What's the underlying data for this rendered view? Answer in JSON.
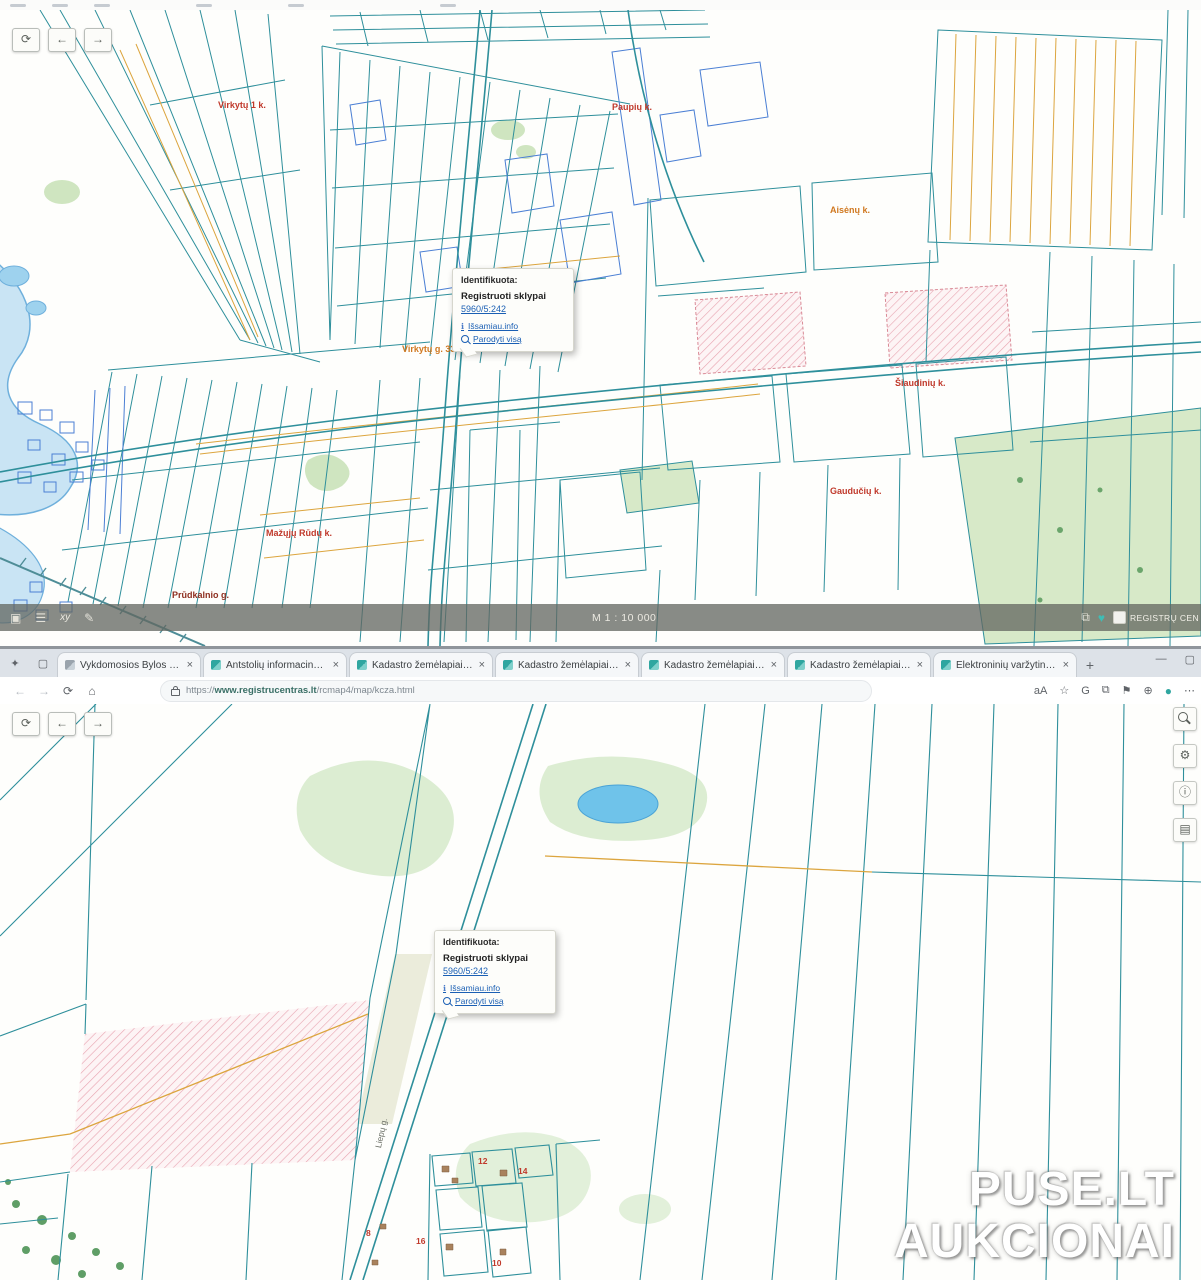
{
  "colors": {
    "teal": "#2e8f9b",
    "blue": "#4b7fd4",
    "orange": "#dca53e",
    "water": "#79c2e8",
    "green": "#d9ecd0",
    "pink": "#e6a7b4",
    "link": "#1a5fb4",
    "label-red": "#c0392b",
    "label-orange": "#d07820",
    "heart": "#3fbdb5"
  },
  "watermark": {
    "line1": "PUSE.LT",
    "line2": "AUKCIONAI"
  },
  "top_map": {
    "popup": {
      "header": "Identifikuota:",
      "title": "Registruoti sklypai",
      "parcel_link": "5960/5:242",
      "info_link": "Išsamiau.info",
      "zoom_link": "Parodyti visą"
    },
    "labels": [
      {
        "text": "Virkytų 1 k."
      },
      {
        "text": "Paupių k."
      },
      {
        "text": "Aisėnų k."
      },
      {
        "text": "Šiaudinių k."
      },
      {
        "text": "Gaudučių k."
      },
      {
        "text": "Mažųjų Rūdų k."
      },
      {
        "text": "Virkytų g. 33 k."
      },
      {
        "text": "Prūdkalnio g."
      }
    ],
    "statusbar": {
      "xy_label": "xy",
      "scale": "M 1 : 10 000",
      "brand": "REGISTRŲ CENTRAS"
    }
  },
  "browser": {
    "tabs": [
      {
        "label": "Vykdomosios Bylos Portalas"
      },
      {
        "label": "Antstolių informacinė sistema"
      },
      {
        "label": "Kadastro žemėlapiai 4.1.25"
      },
      {
        "label": "Kadastro žemėlapiai 4.1.25"
      },
      {
        "label": "Kadastro žemėlapiai 4.1.25"
      },
      {
        "label": "Kadastro žemėlapiai 4.1.25"
      },
      {
        "label": "Elektroninių varžytinių ir aukc..."
      }
    ],
    "url_prefix": "https://",
    "url_domain": "www.registrucentras.lt",
    "url_path": "/rcmap4/map/kcza.html"
  },
  "bottom_map": {
    "popup": {
      "header": "Identifikuota:",
      "title": "Registruoti sklypai",
      "parcel_link": "5960/5:242",
      "info_link": "Išsamiau.info",
      "zoom_link": "Parodyti visą"
    },
    "road_label": "Liepų g.",
    "parcel_numbers": [
      {
        "n": "12"
      },
      {
        "n": "14"
      },
      {
        "n": "8"
      },
      {
        "n": "16"
      },
      {
        "n": "10"
      }
    ]
  },
  "icons": {
    "back": "←",
    "forward": "→",
    "reset": "⟳",
    "close": "×",
    "new_tab": "+",
    "minimize": "—",
    "restore": "▢",
    "reload": "⟳",
    "home": "⌂",
    "tab_list": "▢",
    "translate": "aA",
    "favorites": "☆",
    "g_ext": "G",
    "split": "⧉",
    "collections": "⚑",
    "extensions": "⊕",
    "profile": "●",
    "more": "⋯",
    "layers": "▣",
    "measure": "☰",
    "draw": "✎",
    "fullscreen": "⧉",
    "heart": "♥",
    "gear": "⚙",
    "info": "ⓘ",
    "layers2": "▤",
    "info_small": "ℹ"
  }
}
